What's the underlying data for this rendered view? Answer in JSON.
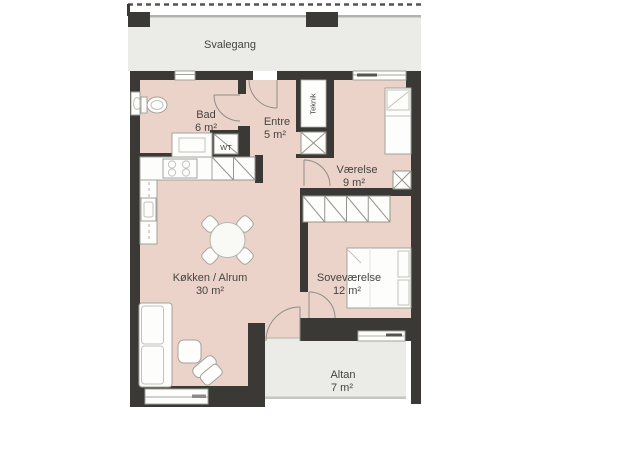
{
  "plan": {
    "title": "apartment-floor-plan",
    "rooms": {
      "svalegang": {
        "name": "Svalegang"
      },
      "bad": {
        "name": "Bad",
        "area": "6 m²"
      },
      "entre": {
        "name": "Entre",
        "area": "5 m²"
      },
      "teknik": {
        "name": "Teknik"
      },
      "wt": {
        "name": "WT"
      },
      "vaerelse": {
        "name": "Værelse",
        "area": "9 m²"
      },
      "sovevaerelse": {
        "name": "Soveværelse",
        "area": "12 m²"
      },
      "koekken": {
        "name": "Køkken / Alrum",
        "area": "30 m²"
      },
      "altan": {
        "name": "Altan",
        "area": "7 m²"
      }
    },
    "colors": {
      "wall": "#3a3936",
      "floor": "#ecd3ca",
      "outdoor": "#ebece7",
      "furniture_outline": "#a2a29c",
      "label_text": "#45443f",
      "background": "#ffffff"
    }
  }
}
